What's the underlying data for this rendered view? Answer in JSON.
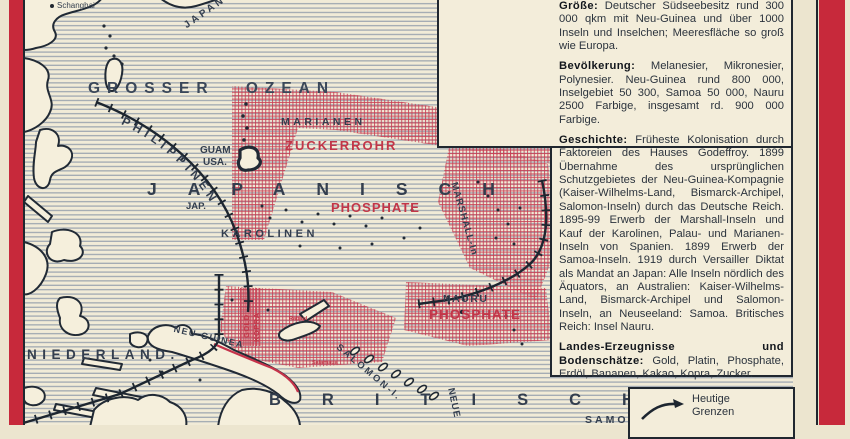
{
  "frame": {
    "accent_red": "#c7293b",
    "background": "#ece5cf"
  },
  "map": {
    "colors": {
      "hatch_red": "#c74256",
      "label_red": "#c23648",
      "label_dark": "#333e4e",
      "ocean_line": "#97a1ad",
      "land": "#f5efdc",
      "coast": "#212a35"
    },
    "labels": {
      "shanghai": "Schanghai",
      "japan": "JAPAN",
      "grosser_ozean": "GROSSER OZEAN",
      "philippinen": "PHILIPPINEN",
      "marianen": "MARIANEN",
      "zuckerrohr": "ZUCKERROHR",
      "guam": "GUAM",
      "guam_sub": "USA.",
      "japanisch": "JAPANISCH",
      "jap_abbr": "JAP.",
      "phosphate_karolinen": "PHOSPHATE",
      "karolinen": "KAROLINEN",
      "marshall": "MARSHALL-In",
      "nauru": "NAURU",
      "phosphate_nauru": "PHOSPHATE",
      "niederland": "NIEDERLAND.",
      "neu_guinea": "NEU-GUINEA",
      "gold": "GOLD",
      "kopra": "KOPRA",
      "salomon": "SALOMON-I.",
      "britisch": "BRITISCH",
      "neue_hebriden": "NEUE",
      "samoa": "SAMOA",
      "rabaul": "Rabaul",
      "salamaua": "Salamaua"
    }
  },
  "info_box": {
    "sections": [
      {
        "head": "Größe:",
        "body": "Deutscher Südseebesitz rund 300 000 qkm mit Neu-Guinea und über 1000 Inseln und Inselchen; Meeresfläche so groß wie Europa."
      },
      {
        "head": "Bevölkerung:",
        "body": "Melanesier, Mikronesier, Polynesier. Neu-Guinea rund 800 000, Inselgebiet 50 300, Samoa 50 000, Nauru 2500 Farbige, insgesamt rd. 900 000 Farbige."
      },
      {
        "head": "Geschichte:",
        "body": "Früheste Kolonisation durch Faktoreien des Hauses Godeffroy. 1899 Übernahme des ursprünglichen Schutzgebietes der Neu-Guinea-Kompagnie (Kaiser-Wilhelms-Land, Bismarck-Archipel, Salomon-Inseln) durch das Deutsche Reich. 1895-99 Erwerb der Marshall-Inseln und Kauf der Karolinen, Palau- und Marianen-Inseln von Spanien. 1899 Erwerb der Samoa-Inseln. 1919 durch Versailler Diktat als Mandat an Japan: Alle Inseln nördlich des Äquators, an Australien: Kaiser-Wilhelms-Land, Bismarck-Archipel und Salomon-Inseln, an Neuseeland: Samoa. Britisches Reich: Insel Nauru."
      },
      {
        "head": "Landes-Erzeugnisse und Bodenschätze:",
        "body": "Gold, Platin, Phosphate, Erdöl, Bananen, Kakao, Kopra, Zucker."
      }
    ]
  },
  "legend": {
    "label": "Heutige Grenzen"
  }
}
